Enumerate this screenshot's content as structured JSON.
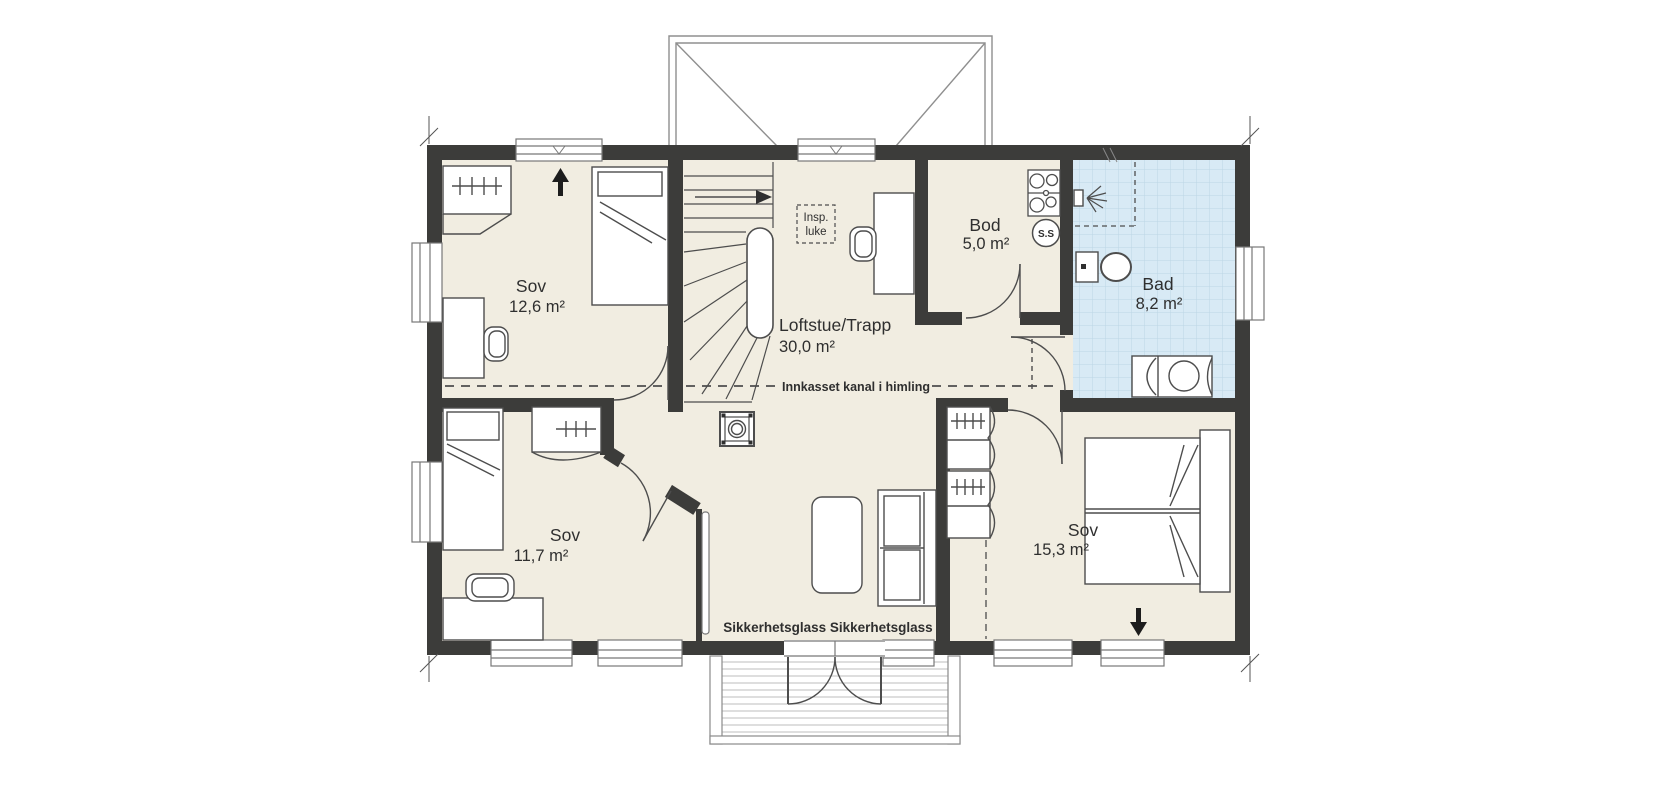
{
  "rooms": [
    {
      "name": "Sov",
      "area": "12,6 m²"
    },
    {
      "name": "Loftstue/Trapp",
      "area": "30,0 m²"
    },
    {
      "name": "Bod",
      "area": "5,0 m²"
    },
    {
      "name": "Bad",
      "area": "8,2 m²"
    },
    {
      "name": "Sov",
      "area": "11,7 m²"
    },
    {
      "name": "Sov",
      "area": "15,3 m²"
    }
  ],
  "annotations": {
    "inspection_hatch_line1": "Insp.",
    "inspection_hatch_line2": "luke",
    "ceiling_duct": "Innkasset kanal i himling",
    "safety_glass": "Sikkerhetsglass Sikkerhetsglass",
    "ss_marker": "S.S"
  },
  "icons": {
    "north_arrow": "↑",
    "exit_arrow": "↓",
    "stair_direction_arrow": "→"
  },
  "colors": {
    "wall": "#3c3c3a",
    "floor": "#f1ede1",
    "bathroom_floor": "#d8eaf5",
    "bathroom_grid": "#bcd6e5",
    "furniture_line": "#4d4d4d",
    "text": "#2f2f2f"
  }
}
